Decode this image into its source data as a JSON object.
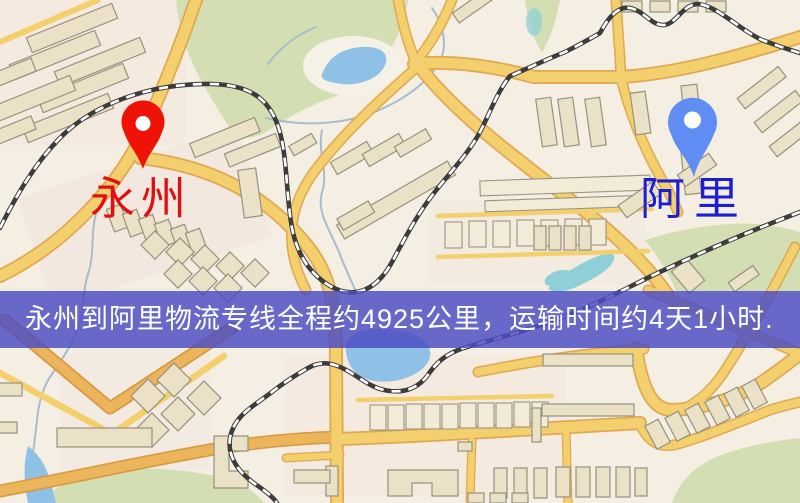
{
  "map": {
    "origin": {
      "name": "永州"
    },
    "destination": {
      "name": "阿里"
    },
    "banner": {
      "text": "永州到阿里物流专线全程约4925公里，运输时间约4天1小时."
    },
    "icons": {
      "origin_pin": "red-map-pin-icon",
      "destination_pin": "blue-map-pin-icon"
    },
    "colors": {
      "background": "#f4eee3",
      "pink_zone": "#f3e4dc",
      "park": "#d3dfb2",
      "water": "#8fc1e7",
      "teal_water": "#8fd0d8",
      "stream": "#a9bccb",
      "road": "#f3cf6e",
      "road_casing": "#e0a851",
      "road_orange": "#edb55b",
      "road_orange_casing": "#d6993f",
      "building": "#eae1c6",
      "railway": "#3c3c3c",
      "origin_pin": "#ef1206",
      "origin_label": "#e11010",
      "destination_pin": "#5f8df3",
      "destination_label": "#1d1dd2",
      "banner_bg": "rgba(76,78,196,0.84)",
      "banner_text": "#ffffff"
    }
  }
}
